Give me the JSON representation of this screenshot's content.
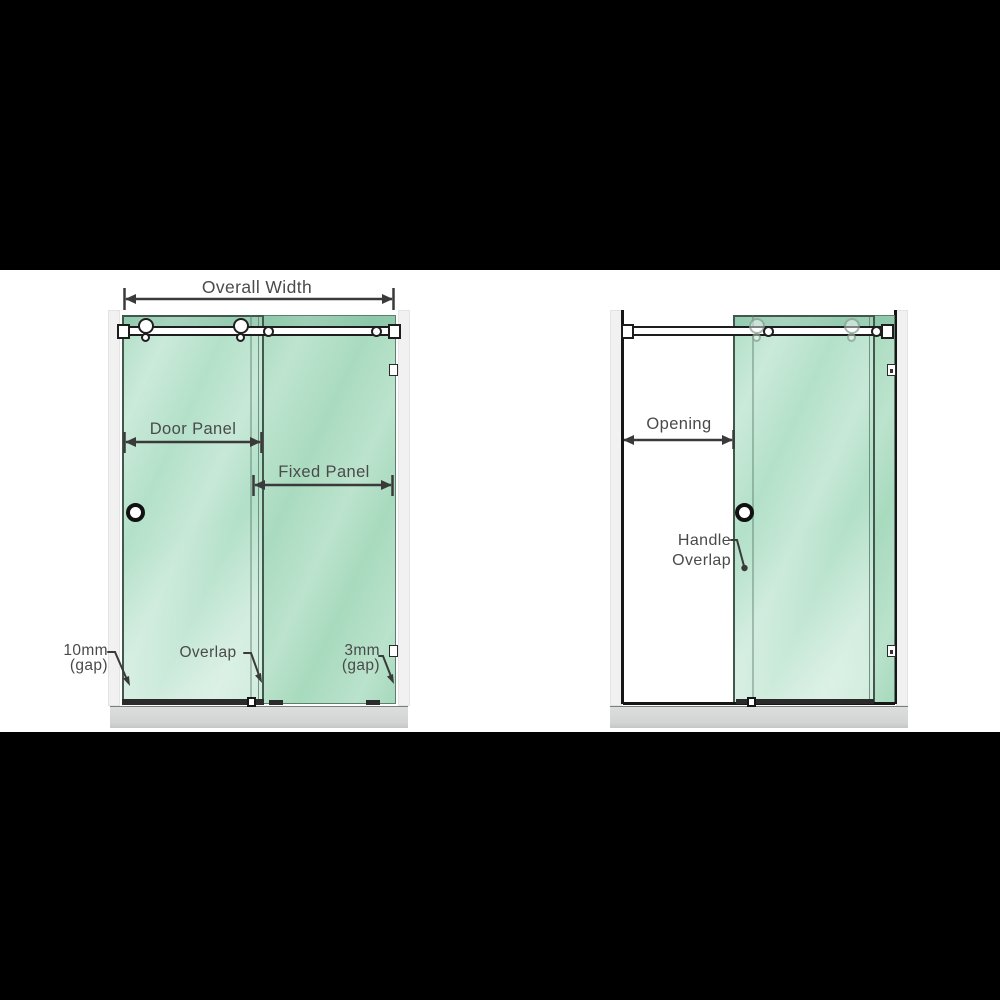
{
  "colors": {
    "background": "#000000",
    "canvas": "#ffffff",
    "glass": "#a9dcc1",
    "glass_top_band": "#8fcfae",
    "hardware_outline": "#1d1d1d",
    "wall": "#f1f1f1",
    "floor": "#d5d7d6",
    "label_text": "#4a4a4a"
  },
  "left_diagram": {
    "overall_width_label": "Overall Width",
    "door_panel_label": "Door Panel",
    "fixed_panel_label": "Fixed Panel",
    "gap_left_value": "10mm",
    "gap_left_unit": "(gap)",
    "overlap_label": "Overlap",
    "gap_right_value": "3mm",
    "gap_right_unit": "(gap)"
  },
  "right_diagram": {
    "opening_label": "Opening",
    "handle_overlap_line1": "Handle",
    "handle_overlap_line2": "Overlap"
  }
}
